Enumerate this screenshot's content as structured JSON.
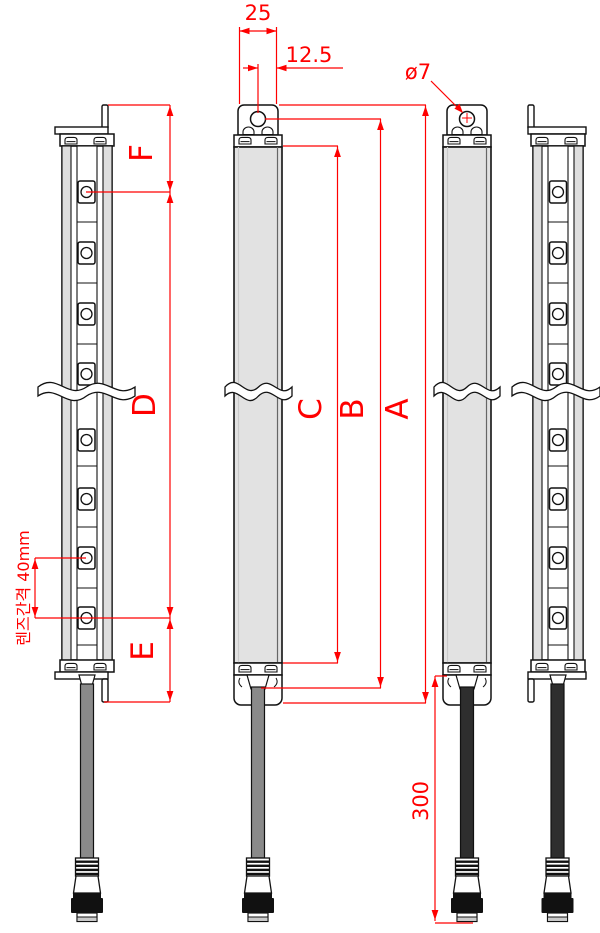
{
  "drawing": {
    "type": "mechanical-dimension-drawing",
    "views": [
      "side-view-left",
      "front-view-emitter",
      "front-view-receiver",
      "side-view-right"
    ],
    "labels": {
      "bracket_width": "25",
      "hole_offset": "12.5",
      "hole_diameter": "ø7",
      "dim_a": "A",
      "dim_b": "B",
      "dim_c": "C",
      "dim_d": "D",
      "dim_e": "E",
      "dim_f": "F",
      "cable_length": "300",
      "lens_pitch_note": "렌즈간격 40mm"
    },
    "colors": {
      "dimension_red": "#ff0000",
      "outline": "#111111",
      "body_fill": "#e2e2e2",
      "rail_fill": "#dedede",
      "cable_gray": "#8a8a8a",
      "cable_black": "#2e2e2e"
    }
  }
}
